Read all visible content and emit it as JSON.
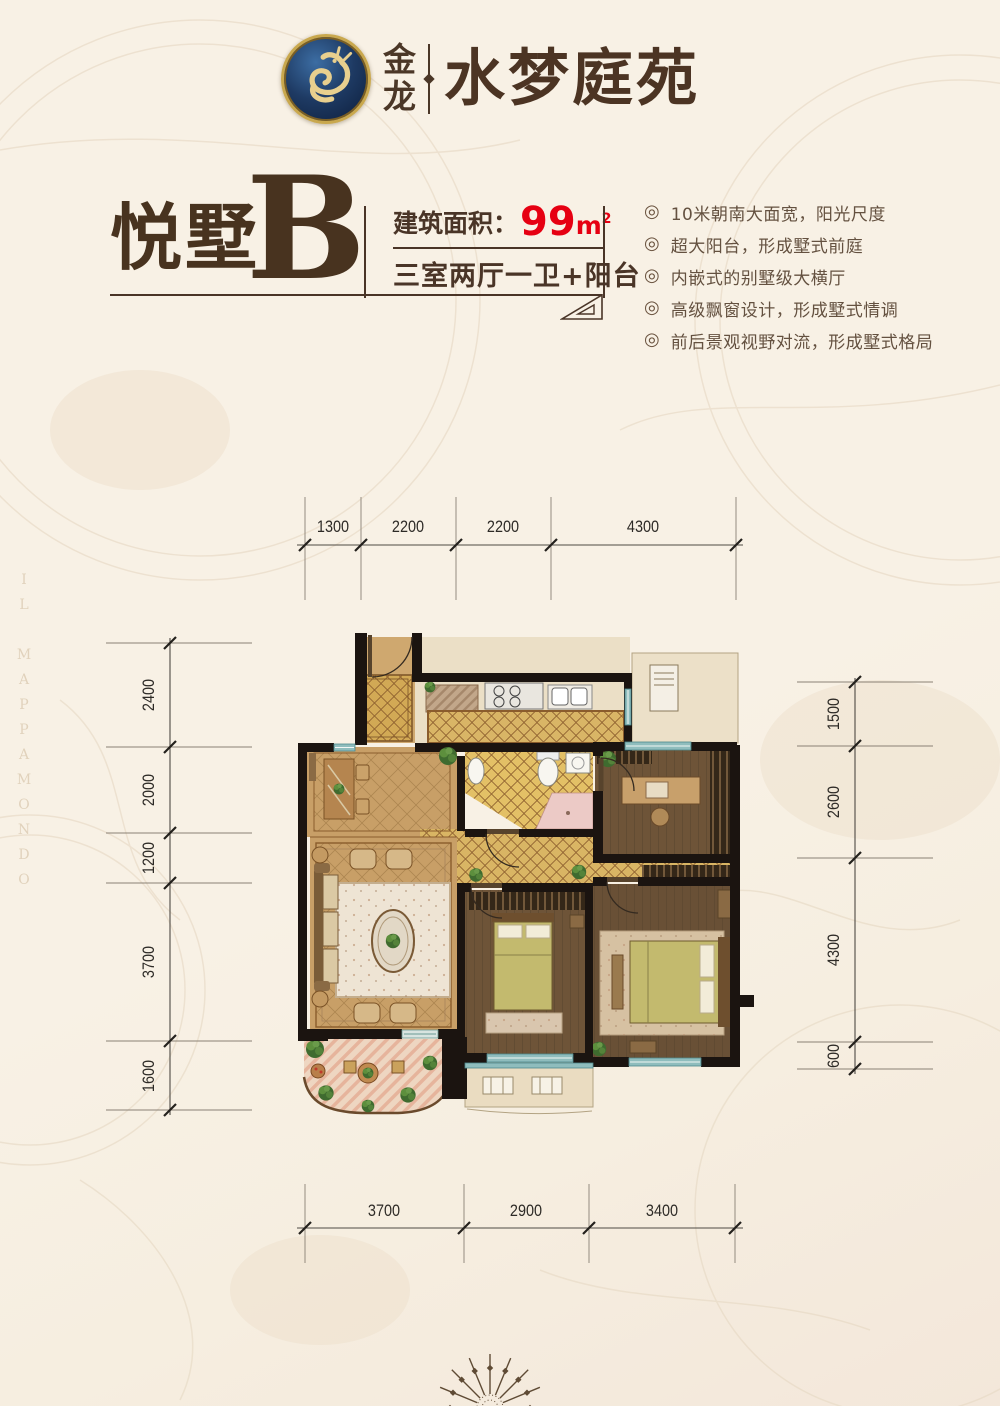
{
  "header": {
    "brand_char_top": "金",
    "brand_char_bottom": "龙",
    "brand_name": "水梦庭苑"
  },
  "unit": {
    "name": "悦墅",
    "letter": "B",
    "area_label": "建筑面积：",
    "area_value": "99",
    "area_unit": "m",
    "area_sup": "2",
    "layout": "三室两厅一卫+阳台"
  },
  "features": {
    "bullet": "◎",
    "items": [
      "10米朝南大面宽，阳光尺度",
      "超大阳台，形成墅式前庭",
      "内嵌式的别墅级大横厅",
      "高级飘窗设计，形成墅式情调",
      "前后景观视野对流，形成墅式格局"
    ]
  },
  "dimensions": {
    "top": [
      "1300",
      "2200",
      "2200",
      "4300"
    ],
    "bottom": [
      "3700",
      "2900",
      "3400"
    ],
    "left": [
      "2400",
      "2000",
      "1200",
      "3700",
      "1600"
    ],
    "right": [
      "1500",
      "2600",
      "4300",
      "600"
    ]
  },
  "watermark": {
    "map_text": "IL MAPPAMONDO"
  },
  "colors": {
    "accent_red": "#e60012",
    "brand_brown": "#4a3527",
    "wall_black": "#1b1410",
    "window_teal": "#8fbdbd",
    "tile_yellow": "#d9b564",
    "wood_tan": "#c89f67",
    "plank_brown": "#6e5438",
    "page_bg": "#f7f0e4"
  }
}
